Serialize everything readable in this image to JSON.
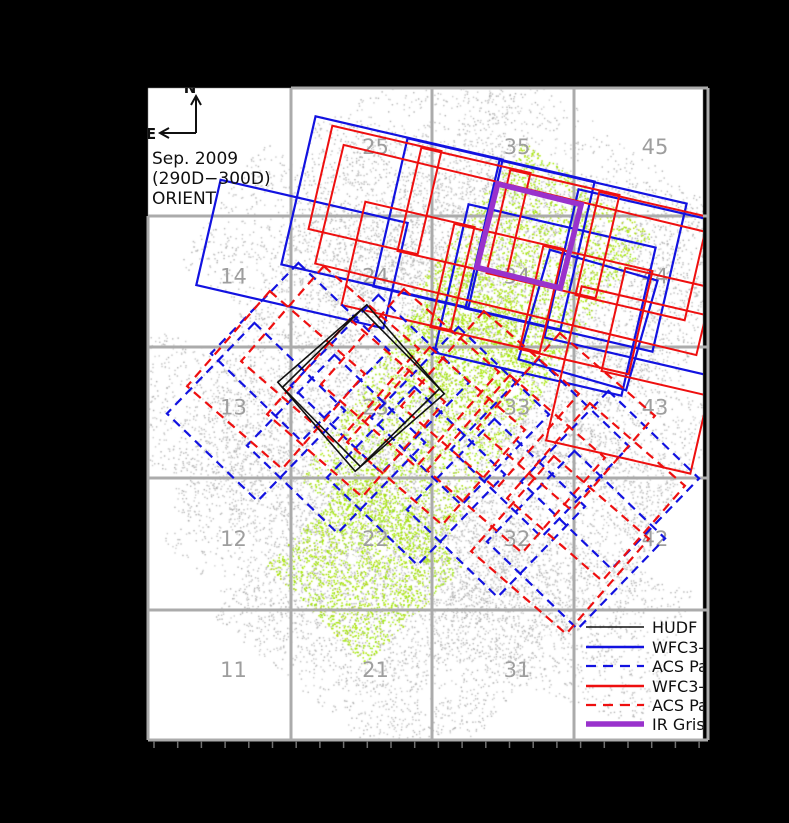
{
  "figure": {
    "annotation": {
      "line1": "Sep. 2009",
      "line2": "(290D−300D)",
      "line3": "ORIENT"
    },
    "compass": {
      "north": "N",
      "east": "E"
    }
  },
  "legend": {
    "items": [
      {
        "label": "HUDF",
        "color": "#101010",
        "dash": "",
        "lw": 1.6
      },
      {
        "label": "WFC3-I",
        "color": "#1212e0",
        "dash": "",
        "lw": 2.6
      },
      {
        "label": "ACS Pa",
        "color": "#1212e0",
        "dash": "10,7",
        "lw": 2.2
      },
      {
        "label": "WFC3-I",
        "color": "#ee0f0f",
        "dash": "",
        "lw": 2.6
      },
      {
        "label": "ACS Pa",
        "color": "#ee0f0f",
        "dash": "10,7",
        "lw": 2.2
      },
      {
        "label": "IR Grism",
        "color": "#9932cc",
        "dash": "",
        "lw": 5.5
      }
    ],
    "layout": {
      "x_line0": 586,
      "x_line1": 644,
      "x_text": 652,
      "rows_y": [
        627,
        647,
        666,
        686,
        705,
        724
      ]
    }
  },
  "chart_data": {
    "type": "scatter",
    "title": "HST survey pointing layout over galaxy field, Sep. 2009 (290D-300D) ORIENT",
    "plot_area": {
      "x": 148,
      "y": 88,
      "w": 555,
      "h": 652
    },
    "colors": {
      "background": "#000000",
      "plot_bg": "#ffffff",
      "grid": "#ababab",
      "tile_label": "#9e9e9e",
      "gray_scatter": "#b4b4b4",
      "green_scatter": "#a4e40a",
      "blue": "#1212e0",
      "red": "#ee0f0f",
      "purple": "#9932cc",
      "black": "#101010",
      "tick": "#707070"
    },
    "grid": {
      "x_lines": [
        148,
        291,
        432,
        574,
        708
      ],
      "y_lines": [
        88,
        216,
        347,
        478,
        610,
        740
      ],
      "line_width": 3,
      "missing_top_left_tile": "15",
      "col_centers": [
        219.5,
        361.5,
        503,
        641
      ],
      "row_centers_bottom_up": [
        675,
        544,
        412.5,
        281.5,
        152
      ],
      "bottom_ticks": {
        "y0": 741,
        "y1": 748,
        "x0": 154,
        "x1": 702,
        "step": 23.7
      }
    },
    "tile_labels": [
      {
        "t": "11",
        "c": 0,
        "r": 0
      },
      {
        "t": "21",
        "c": 1,
        "r": 0
      },
      {
        "t": "31",
        "c": 2,
        "r": 0
      },
      {
        "t": "12",
        "c": 0,
        "r": 1
      },
      {
        "t": "22",
        "c": 1,
        "r": 1
      },
      {
        "t": "32",
        "c": 2,
        "r": 1
      },
      {
        "t": "42",
        "c": 3,
        "r": 1
      },
      {
        "t": "13",
        "c": 0,
        "r": 2
      },
      {
        "t": "23",
        "c": 1,
        "r": 2
      },
      {
        "t": "33",
        "c": 2,
        "r": 2
      },
      {
        "t": "43",
        "c": 3,
        "r": 2
      },
      {
        "t": "14",
        "c": 0,
        "r": 3
      },
      {
        "t": "24",
        "c": 1,
        "r": 3
      },
      {
        "t": "34",
        "c": 2,
        "r": 3
      },
      {
        "t": "44",
        "c": 3,
        "r": 3
      },
      {
        "t": "25",
        "c": 1,
        "r": 4
      },
      {
        "t": "35",
        "c": 2,
        "r": 4
      },
      {
        "t": "45",
        "c": 3,
        "r": 4
      }
    ],
    "gray_regions": [
      {
        "cx": 500,
        "cy": 248,
        "w": 420,
        "h": 185,
        "rot": 13,
        "n": 2600
      },
      {
        "cx": 455,
        "cy": 390,
        "w": 300,
        "h": 600,
        "rot": 36,
        "n": 4200
      },
      {
        "cx": 425,
        "cy": 485,
        "w": 470,
        "h": 220,
        "rot": 20,
        "n": 3300
      },
      {
        "cx": 400,
        "cy": 610,
        "w": 280,
        "h": 250,
        "rot": 40,
        "n": 2300
      },
      {
        "cx": 425,
        "cy": 215,
        "w": 170,
        "h": 260,
        "rot": 5,
        "n": 1100
      },
      {
        "cx": 215,
        "cy": 420,
        "w": 200,
        "h": 130,
        "rot": 20,
        "n": 800
      },
      {
        "cx": 610,
        "cy": 430,
        "w": 180,
        "h": 150,
        "rot": 36,
        "n": 900
      },
      {
        "cx": 560,
        "cy": 618,
        "w": 230,
        "h": 150,
        "rot": 20,
        "n": 1000
      },
      {
        "cx": 305,
        "cy": 262,
        "w": 210,
        "h": 150,
        "rot": 36,
        "n": 900
      }
    ],
    "green_regions": [
      {
        "cx": 533,
        "cy": 262,
        "w": 160,
        "h": 185,
        "rot": 36,
        "n": 2000
      },
      {
        "cx": 425,
        "cy": 428,
        "w": 155,
        "h": 225,
        "rot": 33,
        "n": 2200
      },
      {
        "cx": 365,
        "cy": 565,
        "w": 140,
        "h": 140,
        "rot": 45,
        "n": 1700
      },
      {
        "cx": 470,
        "cy": 340,
        "w": 120,
        "h": 120,
        "rot": 36,
        "n": 900
      }
    ],
    "white_holes": [
      [
        300,
        378,
        7
      ],
      [
        258,
        441,
        6
      ],
      [
        352,
        560,
        5
      ],
      [
        303,
        500,
        4
      ],
      [
        431,
        170,
        5
      ],
      [
        548,
        641,
        6
      ],
      [
        233,
        628,
        5
      ],
      [
        612,
        598,
        4
      ],
      [
        660,
        481,
        4
      ],
      [
        214,
        333,
        4
      ],
      [
        514,
        389,
        5
      ],
      [
        468,
        563,
        4
      ],
      [
        395,
        308,
        4
      ],
      [
        585,
        205,
        4
      ],
      [
        640,
        360,
        4
      ]
    ],
    "pointings": {
      "wfc3_blue_solid": [
        {
          "cx": 392,
          "cy": 212,
          "w": 192,
          "h": 152,
          "rot": 13
        },
        {
          "cx": 484,
          "cy": 234,
          "w": 192,
          "h": 152,
          "rot": 13
        },
        {
          "cx": 576,
          "cy": 256,
          "w": 192,
          "h": 152,
          "rot": 13
        },
        {
          "cx": 655,
          "cy": 285,
          "w": 192,
          "h": 152,
          "rot": 13
        },
        {
          "cx": 545,
          "cy": 300,
          "w": 192,
          "h": 152,
          "rot": 13
        },
        {
          "cx": 588,
          "cy": 320,
          "w": 112,
          "h": 114,
          "rot": 16
        },
        {
          "cx": 302,
          "cy": 254,
          "w": 192,
          "h": 108,
          "rot": 13
        }
      ],
      "wfc3_red_solid": [
        {
          "cx": 375,
          "cy": 190,
          "w": 112,
          "h": 106,
          "rot": 13
        },
        {
          "cx": 464,
          "cy": 212,
          "w": 112,
          "h": 106,
          "rot": 13
        },
        {
          "cx": 553,
          "cy": 234,
          "w": 112,
          "h": 106,
          "rot": 13
        },
        {
          "cx": 642,
          "cy": 256,
          "w": 112,
          "h": 106,
          "rot": 13
        },
        {
          "cx": 408,
          "cy": 266,
          "w": 112,
          "h": 106,
          "rot": 13
        },
        {
          "cx": 497,
          "cy": 288,
          "w": 112,
          "h": 106,
          "rot": 13
        },
        {
          "cx": 586,
          "cy": 310,
          "w": 112,
          "h": 106,
          "rot": 13
        },
        {
          "cx": 668,
          "cy": 332,
          "w": 112,
          "h": 106,
          "rot": 13
        },
        {
          "cx": 520,
          "cy": 250,
          "w": 392,
          "h": 122,
          "rot": 13.5
        },
        {
          "cx": 636,
          "cy": 380,
          "w": 148,
          "h": 158,
          "rot": 13
        }
      ],
      "acs_blue_dashed": [
        {
          "cx": 256,
          "cy": 412,
          "w": 126,
          "h": 126,
          "rot": 44
        },
        {
          "cx": 336,
          "cy": 444,
          "w": 126,
          "h": 126,
          "rot": 44
        },
        {
          "cx": 416,
          "cy": 476,
          "w": 126,
          "h": 126,
          "rot": 44
        },
        {
          "cx": 496,
          "cy": 508,
          "w": 126,
          "h": 126,
          "rot": 44
        },
        {
          "cx": 576,
          "cy": 540,
          "w": 126,
          "h": 126,
          "rot": 44
        },
        {
          "cx": 300,
          "cy": 352,
          "w": 126,
          "h": 126,
          "rot": 44
        },
        {
          "cx": 380,
          "cy": 384,
          "w": 126,
          "h": 126,
          "rot": 44
        },
        {
          "cx": 460,
          "cy": 416,
          "w": 126,
          "h": 126,
          "rot": 44
        },
        {
          "cx": 540,
          "cy": 448,
          "w": 126,
          "h": 126,
          "rot": 44
        },
        {
          "cx": 610,
          "cy": 480,
          "w": 126,
          "h": 126,
          "rot": 44
        }
      ],
      "acs_red_dashed": [
        {
          "cx": 276,
          "cy": 380,
          "w": 126,
          "h": 126,
          "rot": 41
        },
        {
          "cx": 356,
          "cy": 408,
          "w": 126,
          "h": 126,
          "rot": 41
        },
        {
          "cx": 436,
          "cy": 436,
          "w": 126,
          "h": 126,
          "rot": 41
        },
        {
          "cx": 516,
          "cy": 464,
          "w": 126,
          "h": 126,
          "rot": 41
        },
        {
          "cx": 596,
          "cy": 492,
          "w": 126,
          "h": 126,
          "rot": 41
        },
        {
          "cx": 330,
          "cy": 355,
          "w": 126,
          "h": 126,
          "rot": 41
        },
        {
          "cx": 410,
          "cy": 378,
          "w": 126,
          "h": 126,
          "rot": 41
        },
        {
          "cx": 490,
          "cy": 400,
          "w": 126,
          "h": 126,
          "rot": 41
        },
        {
          "cx": 566,
          "cy": 422,
          "w": 126,
          "h": 126,
          "rot": 41
        },
        {
          "cx": 560,
          "cy": 545,
          "w": 126,
          "h": 126,
          "rot": 41
        }
      ],
      "hudf_black": [
        {
          "cx": 361,
          "cy": 388,
          "w": 118,
          "h": 118,
          "rot": 49
        },
        {
          "cx": 361,
          "cy": 388,
          "w": 111,
          "h": 111,
          "rot": 45.5
        }
      ],
      "ir_grism_purple": [
        {
          "cx": 529,
          "cy": 236,
          "w": 86,
          "h": 86,
          "rot": 14
        }
      ]
    },
    "line_widths": {
      "blue_solid": 2.2,
      "red_solid": 2.0,
      "dashed": 2.2,
      "hudf": 1.6,
      "purple": 5.5
    },
    "compass_geometry": {
      "corner": [
        196,
        133
      ],
      "north_tip": [
        196,
        97
      ],
      "east_tip": [
        161,
        133
      ]
    }
  }
}
